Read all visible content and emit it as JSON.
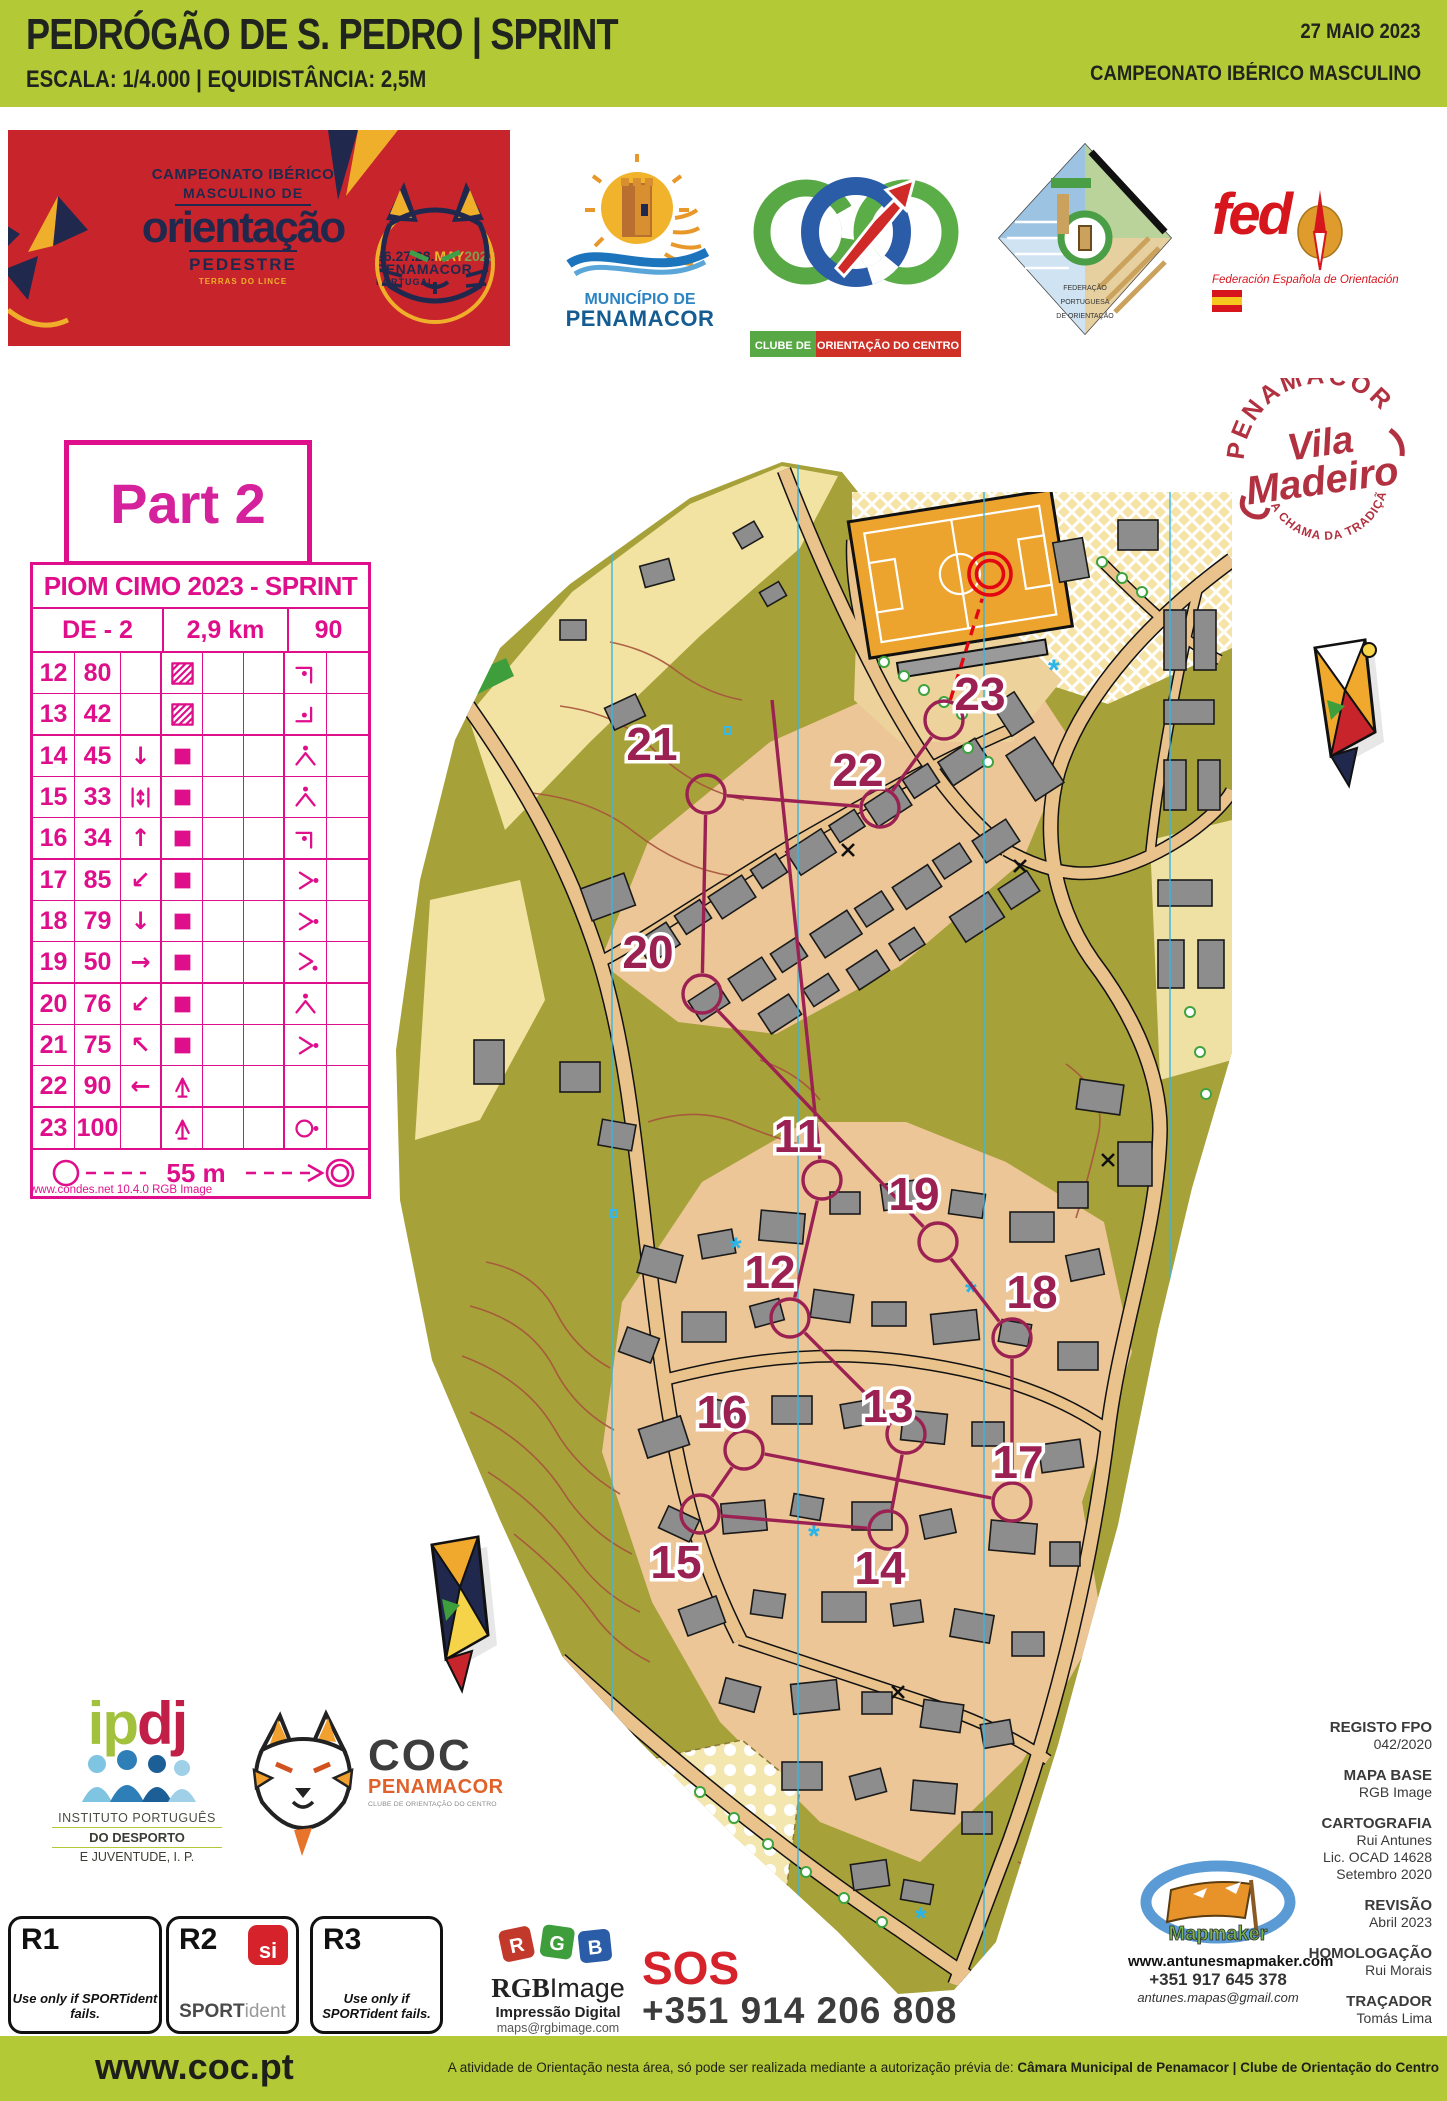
{
  "header": {
    "title": "PEDRÓGÃO DE S. PEDRO  |  SPRINT",
    "subtitle": "ESCALA: 1/4.000  |  EQUIDISTÂNCIA: 2,5M",
    "date": "27 MAIO 2023",
    "championship": "CAMPEONATO IBÉRICO MASCULINO",
    "bar_color": "#b3c935"
  },
  "banner": {
    "line1": "CAMPEONATO IBÉRICO",
    "line2": "MASCULINO DE",
    "word": "orientação",
    "line3": "PEDESTRE",
    "line4": "TERRAS DO LINCE",
    "dates": "26.27.28.",
    "month": "MAY",
    "year": "2023",
    "city": "PENAMACOR",
    "country": "PORTUGAL",
    "bg_color": "#c8242b"
  },
  "logos": {
    "municipio": {
      "line1": "MUNICÍPIO DE",
      "line2": "PENAMACOR"
    },
    "coc": {
      "banner_left": "CLUBE DE",
      "banner_right": "ORIENTAÇÃO DO CENTRO"
    },
    "fpo": {
      "line1": "FEDERAÇÃO",
      "line2": "PORTUGUESA",
      "line3": "DE ORIENTAÇÃO"
    },
    "fedo": {
      "name": "fed",
      "subtitle": "Federación Española de Orientación"
    },
    "vila": {
      "arc_top": "PENAMACOR",
      "script_top": "Vila",
      "script_bottom": "Madeiro",
      "arc_bottom": "A CHAMA DA TRADIÇÃO"
    }
  },
  "part_label": "Part 2",
  "control_table": {
    "title": "PIOM CIMO 2023 - SPRINT",
    "course": "DE - 2",
    "length": "2,9 km",
    "climb": "90",
    "rows": [
      {
        "num": "12",
        "code": "80",
        "c": "",
        "d": "building-passable",
        "g": "corner-ne-dot"
      },
      {
        "num": "13",
        "code": "42",
        "c": "",
        "d": "building-passable",
        "g": "corner-se-dot"
      },
      {
        "num": "14",
        "code": "45",
        "c": "arrow-down",
        "d": "building",
        "g": "spur-dot"
      },
      {
        "num": "15",
        "code": "33",
        "c": "between",
        "d": "building",
        "g": "spur-dot"
      },
      {
        "num": "16",
        "code": "34",
        "c": "arrow-up",
        "d": "building",
        "g": "corner-ne-dot"
      },
      {
        "num": "17",
        "code": "85",
        "c": "arrow-sw",
        "d": "building",
        "g": "side-dot"
      },
      {
        "num": "18",
        "code": "79",
        "c": "arrow-down",
        "d": "building",
        "g": "side-dot"
      },
      {
        "num": "19",
        "code": "50",
        "c": "arrow-right",
        "d": "building",
        "g": "side-dot-low"
      },
      {
        "num": "20",
        "code": "76",
        "c": "arrow-sw",
        "d": "building",
        "g": "spur-dot"
      },
      {
        "num": "21",
        "code": "75",
        "c": "arrow-nw",
        "d": "building",
        "g": "side-dot"
      },
      {
        "num": "22",
        "code": "90",
        "c": "arrow-left",
        "d": "tree",
        "g": ""
      },
      {
        "num": "23",
        "code": "100",
        "c": "",
        "d": "tree",
        "g": "circle-dot"
      }
    ],
    "finish_distance": "55 m",
    "accent_color": "#df0f8c"
  },
  "condes_credit": "www.condes.net 10.4.0 RGB Image",
  "map": {
    "course_color": "#9c2153",
    "finish_color": "#e30613",
    "controls": [
      {
        "n": "11",
        "cx": 822,
        "cy": 1180,
        "lx": 798,
        "ly": 1136
      },
      {
        "n": "12",
        "cx": 790,
        "cy": 1318,
        "lx": 770,
        "ly": 1272
      },
      {
        "n": "13",
        "cx": 906,
        "cy": 1434,
        "lx": 888,
        "ly": 1406
      },
      {
        "n": "14",
        "cx": 888,
        "cy": 1530,
        "lx": 880,
        "ly": 1568
      },
      {
        "n": "15",
        "cx": 700,
        "cy": 1514,
        "lx": 676,
        "ly": 1562
      },
      {
        "n": "16",
        "cx": 744,
        "cy": 1450,
        "lx": 722,
        "ly": 1412
      },
      {
        "n": "17",
        "cx": 1012,
        "cy": 1502,
        "lx": 1018,
        "ly": 1462
      },
      {
        "n": "18",
        "cx": 1012,
        "cy": 1338,
        "lx": 1032,
        "ly": 1292
      },
      {
        "n": "19",
        "cx": 938,
        "cy": 1242,
        "lx": 914,
        "ly": 1194
      },
      {
        "n": "20",
        "cx": 702,
        "cy": 994,
        "lx": 648,
        "ly": 952
      },
      {
        "n": "21",
        "cx": 706,
        "cy": 794,
        "lx": 652,
        "ly": 744
      },
      {
        "n": "22",
        "cx": 880,
        "cy": 808,
        "lx": 858,
        "ly": 770
      },
      {
        "n": "23",
        "cx": 944,
        "cy": 720,
        "lx": 980,
        "ly": 694
      }
    ],
    "finish": {
      "x": 990,
      "y": 574
    }
  },
  "bottom": {
    "ipdj": {
      "g1": "ip",
      "g2": "dj",
      "line1": "INSTITUTO PORTUGUÊS",
      "line2": "DO DESPORTO",
      "line3": "E JUVENTUDE, I. P."
    },
    "coc_club": {
      "name": "COC",
      "city": "PENAMACOR",
      "tagline": "CLUBE DE ORIENTAÇÃO DO CENTRO"
    },
    "r1": {
      "label": "R1",
      "note": "Use only if SPORTident fails."
    },
    "r2": {
      "label": "R2",
      "brand_bold": "SPORT",
      "brand_light": "ident",
      "si": "si"
    },
    "r3": {
      "label": "R3",
      "note": "Use only if SPORTident fails."
    },
    "rgb": {
      "brand_bold": "RGB",
      "brand_light": "Image",
      "line1": "Impressão Digital",
      "line2": "maps@rgbimage.com",
      "line3": "+351 934 949 184"
    },
    "sos": {
      "label": "SOS",
      "phone": "+351 914 206 808"
    },
    "mapmaker": {
      "name": "Mapmaker",
      "site": "www.antunesmapmaker.com",
      "phone": "+351 917 645 378",
      "email": "antunes.mapas@gmail.com"
    },
    "credits": [
      {
        "label": "REGISTO FPO",
        "lines": [
          "042/2020"
        ]
      },
      {
        "label": "MAPA BASE",
        "lines": [
          "RGB Image"
        ]
      },
      {
        "label": "CARTOGRAFIA",
        "lines": [
          "Rui Antunes",
          "Lic. OCAD 14628",
          "Setembro 2020"
        ]
      },
      {
        "label": "REVISÃO",
        "lines": [
          "Abril 2023"
        ]
      },
      {
        "label": "HOMOLOGAÇÃO",
        "lines": [
          "Rui Morais"
        ]
      },
      {
        "label": "TRAÇADOR",
        "lines": [
          "Tomás Lima"
        ]
      }
    ]
  },
  "footer": {
    "site": "www.coc.pt",
    "notice": "A atividade de Orientação nesta área, só pode ser realizada mediante a autorização prévia de: ",
    "notice_bold": "Câmara Municipal de Penamacor | Clube de Orientação do Centro"
  }
}
